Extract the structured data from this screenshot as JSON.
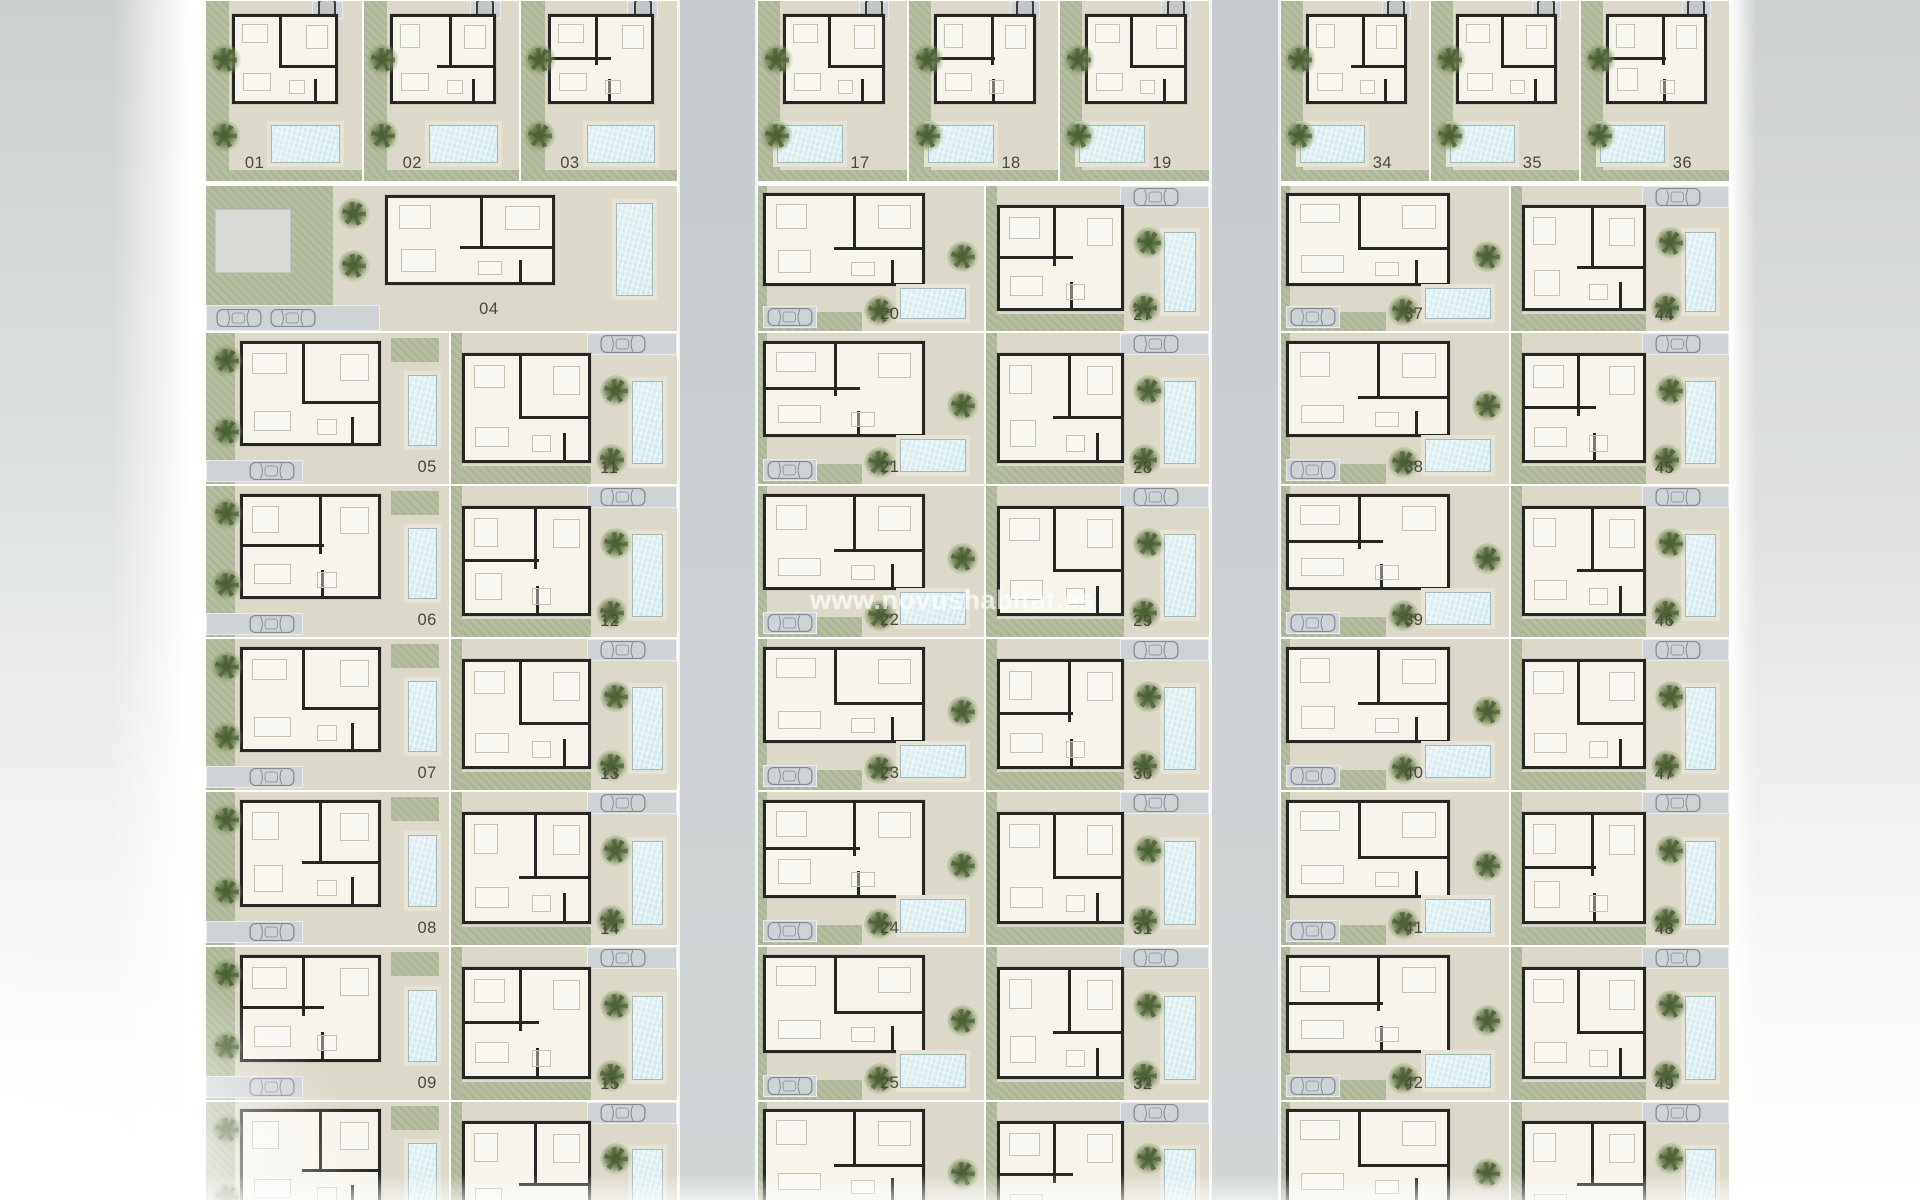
{
  "watermark": "www.novushabitat.es",
  "colors": {
    "page_margin": "#d2d4d4",
    "road": "#c9ced0",
    "driveway": "#ced3d5",
    "garden": "#b2bb9d",
    "patio": "#dcd9ca",
    "house_wall": "#262624",
    "house_floor": "#f7f4ec",
    "pool_water": "#cfe7eb",
    "pool_deck": "#e6e3d4",
    "tree": "#6d8150",
    "plot_number": "#49493f",
    "watermark_color": "#ffffff",
    "car_outline": "#858c90"
  },
  "plan": {
    "blocks": [
      {
        "name": "left",
        "top_row": [
          "01",
          "02",
          "03"
        ],
        "wide_plot": "04",
        "col_a": [
          "05",
          "06",
          "07",
          "08",
          "09",
          ""
        ],
        "col_b": [
          "11",
          "12",
          "13",
          "14",
          "15",
          ""
        ]
      },
      {
        "name": "middle",
        "top_row": [
          "17",
          "18",
          "19"
        ],
        "wide_plot": null,
        "col_a": [
          "20",
          "21",
          "22",
          "23",
          "24",
          "25",
          ""
        ],
        "col_b": [
          "27",
          "28",
          "29",
          "30",
          "31",
          "32",
          ""
        ]
      },
      {
        "name": "right",
        "top_row": [
          "34",
          "35",
          "36"
        ],
        "wide_plot": null,
        "col_a": [
          "37",
          "38",
          "39",
          "40",
          "41",
          "42",
          ""
        ],
        "col_b": [
          "44",
          "45",
          "46",
          "47",
          "48",
          "49",
          ""
        ]
      }
    ]
  }
}
